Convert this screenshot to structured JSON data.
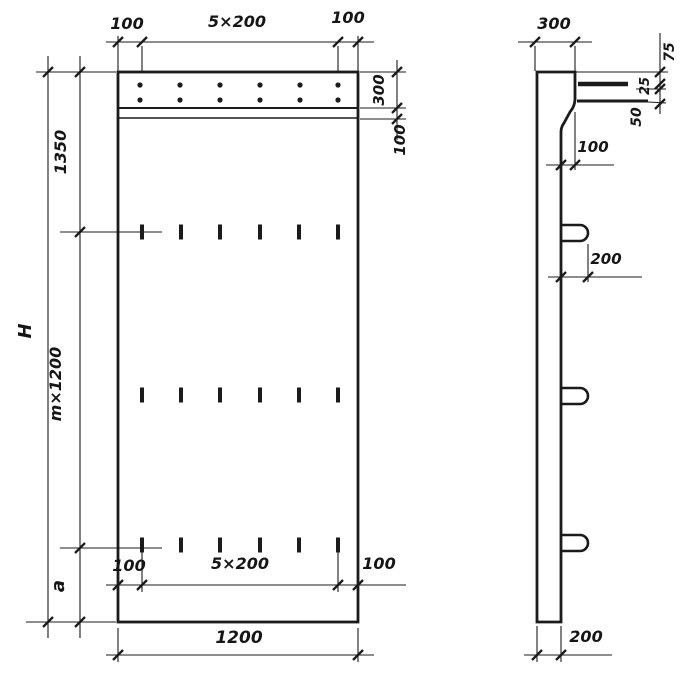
{
  "drawing": {
    "colors": {
      "ink": "#1b1b1b",
      "paper": "#ffffff"
    },
    "views": {
      "front": {
        "top_dim": {
          "left": "100",
          "pitch": "5×200",
          "right": "100"
        },
        "right_dim": {
          "strip": "300",
          "offset": "100"
        },
        "left_dim": {
          "overall": "H",
          "upper": "1350",
          "module": "m×1200",
          "lower": "a"
        },
        "bottom_dim": {
          "left": "100",
          "pitch": "5×200",
          "right": "100"
        },
        "width_dim": "1200"
      },
      "side": {
        "top_width": "300",
        "chain": {
          "upper": "75",
          "middle": "25",
          "lower": "50"
        },
        "taper": "100",
        "loop": "200",
        "thickness": "200"
      }
    }
  }
}
